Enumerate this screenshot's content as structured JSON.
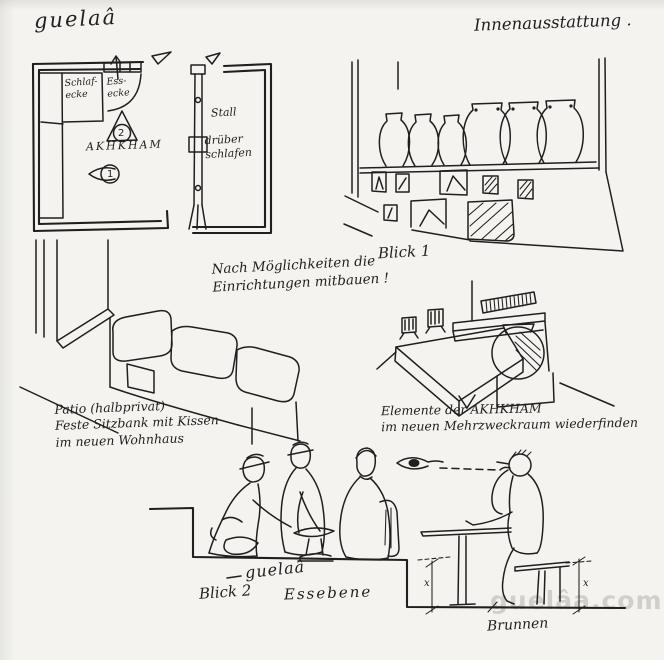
{
  "colors": {
    "paper": "#f4f3ef",
    "ink": "#1f1f1f",
    "watermark": "#b3b2ac"
  },
  "header": {
    "title": "guelaâ",
    "subtitle": "Innenausstattung ."
  },
  "floor_plan": {
    "sleep_corner": "Schlaf-\necke",
    "dining_corner": "Ess-\necke",
    "marker_2": "2",
    "room_name": "AKHKHAM",
    "marker_1": "1"
  },
  "stable_plan": {
    "label_top": "Stall",
    "label_bottom": "drüber\nschlafen"
  },
  "shelf_view": {
    "caption": "Blick 1"
  },
  "center_note": "Nach Möglichkeiten die\nEinrichtungen mitbauen !",
  "patio_sketch": {
    "caption": "Patio (halbprivat)\nFeste Sitzbank mit Kissen\nim neuen Wohnhaus"
  },
  "bed_sketch": {
    "caption": "Elemente der AKHKHAM\nim neuen Mehrzweckraum wiederfinden"
  },
  "dining_view": {
    "label": "guelaâ",
    "view_caption": "Blick 2",
    "level_caption": "Essebene",
    "well_caption": "Brunnen",
    "dim_left": "x",
    "dim_right": "x"
  },
  "watermark": "guelâa.com"
}
